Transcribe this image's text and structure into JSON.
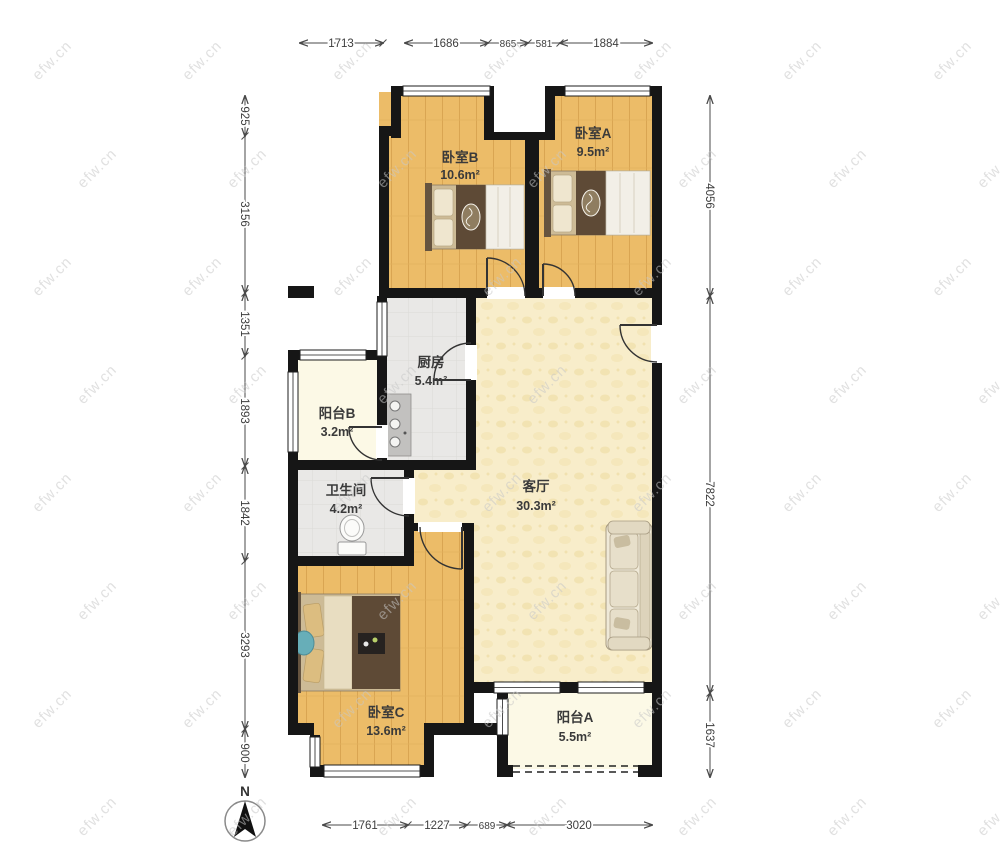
{
  "watermark": {
    "text": "efw.cn"
  },
  "compass": {
    "label": "N"
  },
  "colors": {
    "wall": "#161616",
    "wood_floor": "#ecbc68",
    "wood_line": "#d9a552",
    "living_floor": "#f8edca",
    "balcony_floor": "#fcf9e6",
    "tile_floor": "#e9e8e6",
    "dimension_text": "#3d3d3d",
    "watermark_gray": "#c8c8c8"
  },
  "rooms": {
    "bedroom_b": {
      "name": "卧室B",
      "area": "10.6m²"
    },
    "bedroom_a": {
      "name": "卧室A",
      "area": "9.5m²"
    },
    "kitchen": {
      "name": "厨房",
      "area": "5.4m²"
    },
    "balcony_b": {
      "name": "阳台B",
      "area": "3.2m²"
    },
    "bathroom": {
      "name": "卫生间",
      "area": "4.2m²"
    },
    "living_room": {
      "name": "客厅",
      "area": "30.3m²"
    },
    "bedroom_c": {
      "name": "卧室C",
      "area": "13.6m²"
    },
    "balcony_a": {
      "name": "阳台A",
      "area": "5.5m²"
    }
  },
  "dimensions": {
    "top": [
      "1713",
      "1686",
      "865",
      "581",
      "1884"
    ],
    "left": [
      "925",
      "3156",
      "1351",
      "1893",
      "1842",
      "3293",
      "900"
    ],
    "right": [
      "4056",
      "7822",
      "1637"
    ],
    "bottom": [
      "1761",
      "1227",
      "689",
      "3020"
    ]
  }
}
